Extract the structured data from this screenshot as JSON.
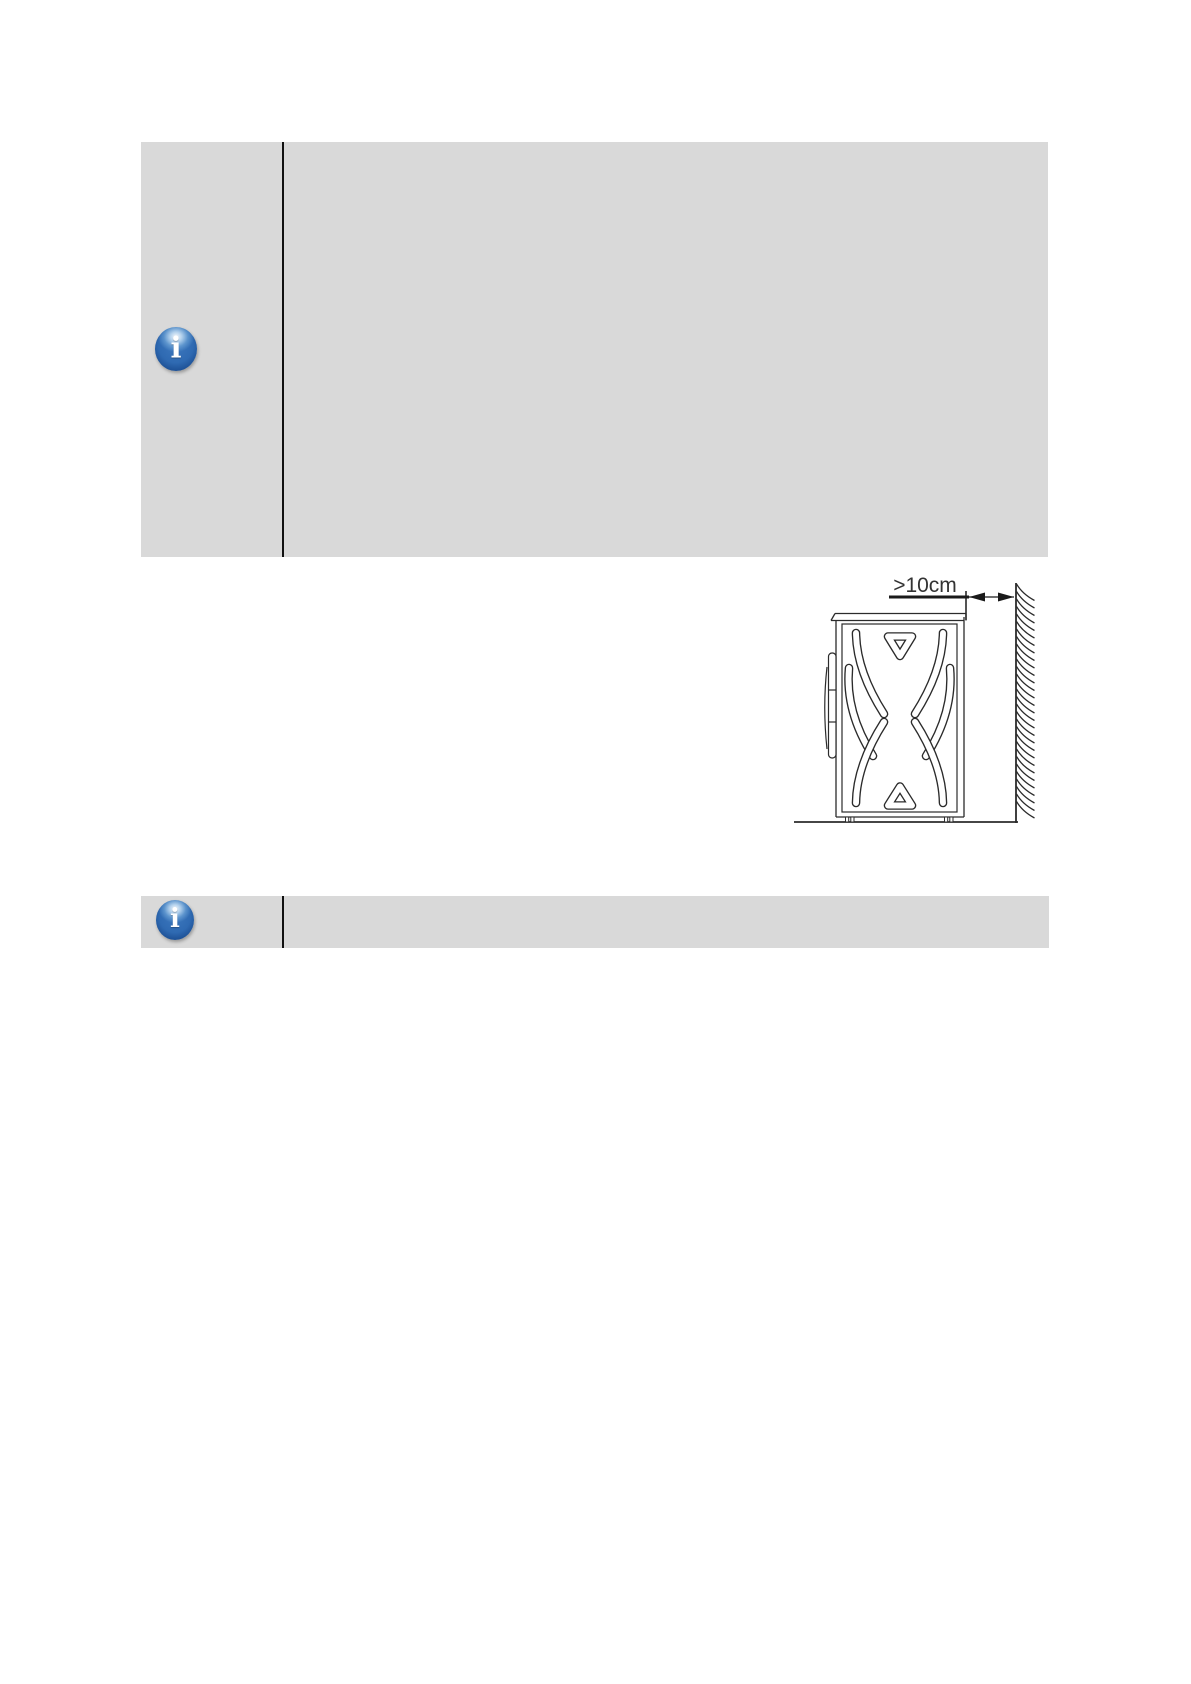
{
  "page": {
    "width_px": 1191,
    "height_px": 1684,
    "background": "#ffffff"
  },
  "colors": {
    "note_box_bg": "#d9d9d9",
    "note_divider": "#111111",
    "drawing_line": "#2b2b2b",
    "dimension_line": "#1a1a1a",
    "label_text": "#333333",
    "icon_blue_dark": "#123e7a",
    "icon_blue_mid": "#2f6ab2",
    "icon_highlight": "#d2e9fa",
    "icon_glyph_color": "#ffffff"
  },
  "note_box_1": {
    "icon_glyph": "i",
    "body_text": ""
  },
  "note_box_2": {
    "icon_glyph": "i",
    "body_text": ""
  },
  "figure": {
    "clearance_label": ">10cm"
  }
}
